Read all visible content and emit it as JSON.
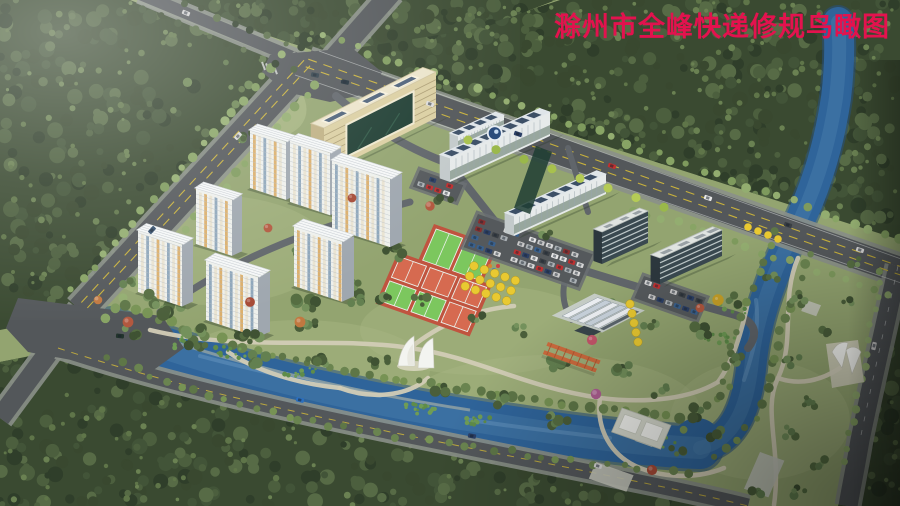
{
  "title": {
    "text": "滁州市全峰快递修规鸟瞰图",
    "color": "#e3124e"
  },
  "scene": {
    "type": "aerial-birdseye-architectural-rendering",
    "features": [
      "forest-belt",
      "highway-intersection",
      "boulevard",
      "river",
      "residential-towers",
      "headquarters-building",
      "office-buildings",
      "solar-roofs",
      "parking-lots",
      "sports-courts",
      "ginkgo-grove",
      "arched-halls",
      "pergola",
      "sail-sculpture",
      "riverside-park",
      "tensile-canopies"
    ],
    "residential_tower_count": 7,
    "palette": {
      "lawn": "#93a470",
      "lawn_light": "#a9b683",
      "meadow": "#a3b27e",
      "forest_base": "#3a4a31",
      "river": "#2f649a",
      "river_light": "#4e81ae",
      "river_deep": "#27517f",
      "road_dark": "#53575a",
      "road_mid": "#60656a",
      "road_edge": "#8b9089",
      "lane_yellow": "#c8b13c",
      "lane_white": "#dadedd",
      "path": "#d2ccb6",
      "tower_face": "#eef0ec",
      "tower_side": "#9fa7af",
      "stripe_orange": "#d7a356",
      "stripe_blue": "#7d99b2",
      "stripe_cream": "#e7e1cd",
      "roof_white": "#f5f7f7",
      "hq_face": "#dbcfa2",
      "hq_side": "#bfb083",
      "hq_roof": "#ebe4ca",
      "glass_green": "#1e3d32",
      "office_face": "#e6eaea",
      "solar": "#33475f",
      "dark_office": "#3a4950",
      "dark_band": "#ccd5d5",
      "court_red": "#c0543f",
      "court_red_light": "#d66a50",
      "court_green": "#7cc75e",
      "court_green_dark": "#4e8a3c",
      "line_white": "#eaf0ea",
      "ginkgo": "#e9c931",
      "pergola": "#cc6a3d",
      "canopy_white": "#f3f4f0",
      "cars": [
        "#e6e6e6",
        "#c03030",
        "#2b3f66",
        "#3a3f44",
        "#d8d8d8",
        "#aab0b4",
        "#8a2f2f",
        "#39618f",
        "#c9c9c9"
      ]
    }
  }
}
